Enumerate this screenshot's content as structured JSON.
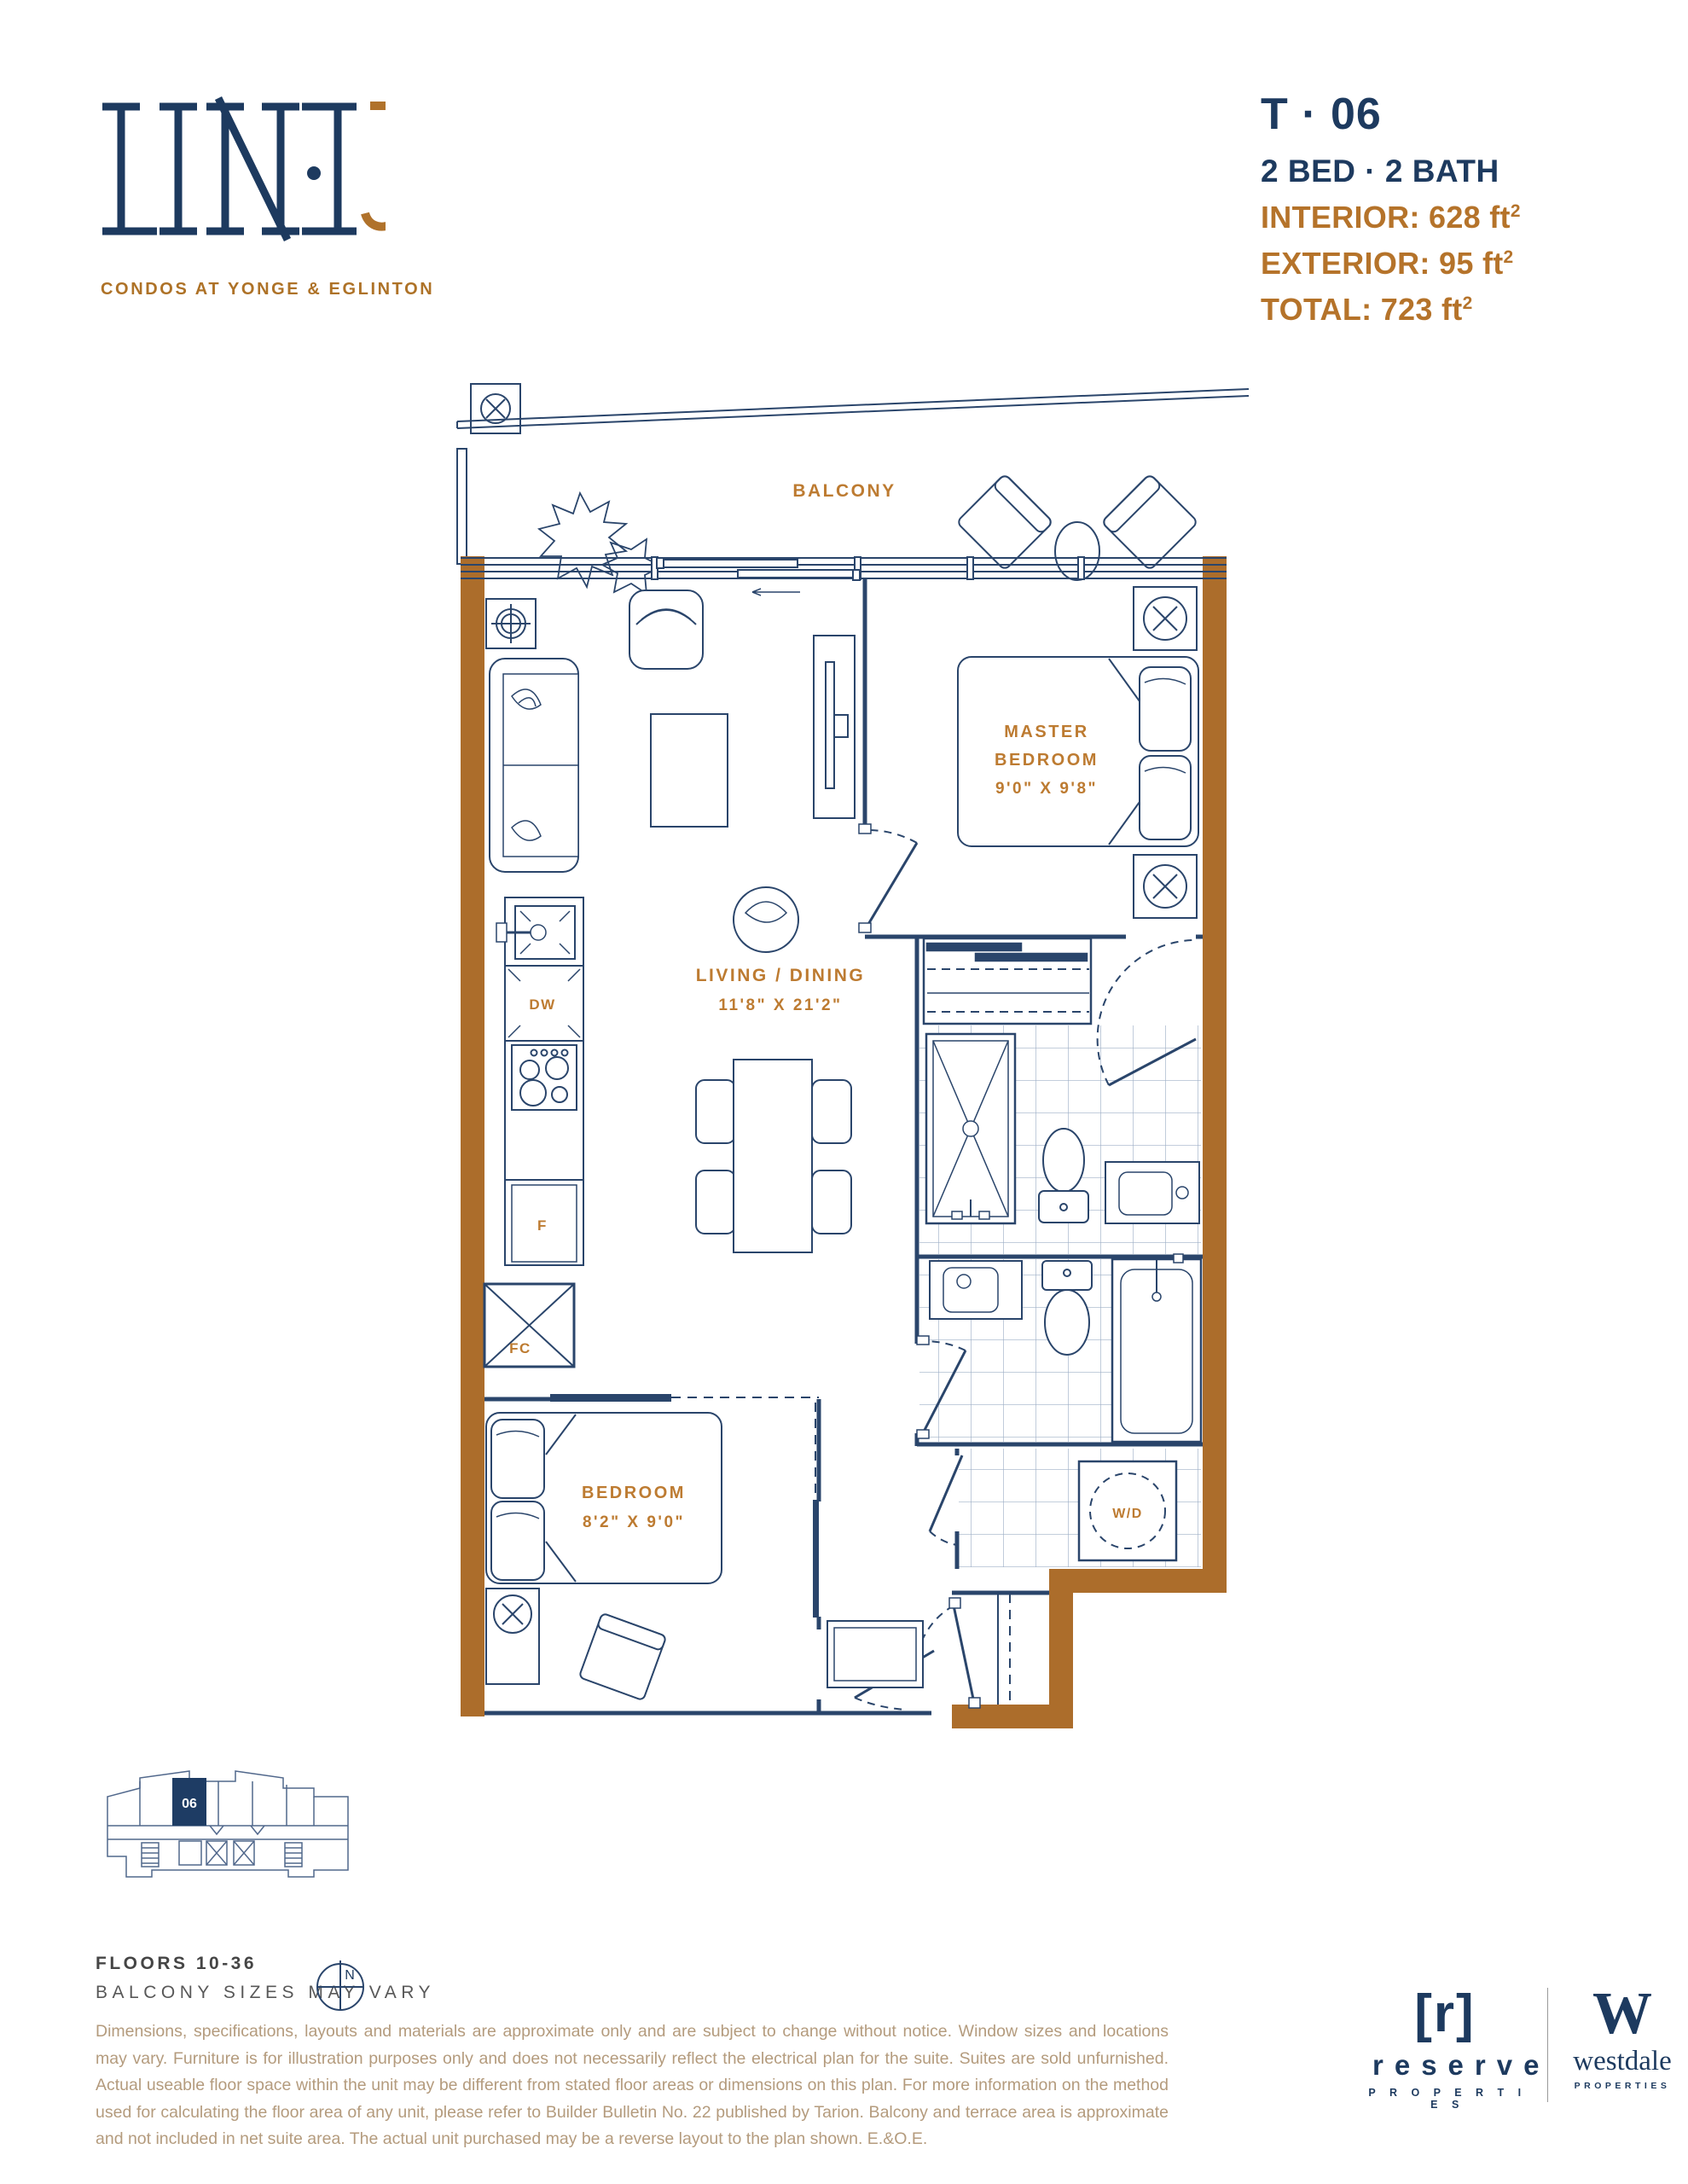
{
  "colors": {
    "navy": "#1d3a5f",
    "line_navy": "#2A456B",
    "wall_brown": "#AC6D2B",
    "label_bronze": "#BD7B31",
    "stat_bronze": "#B5732A",
    "disclaimer_tan": "#B49B7D"
  },
  "logo": {
    "wordmark": "LINE",
    "number": "5",
    "aria": "LINE 5",
    "tagline": "CONDOS AT YONGE & EGLINTON"
  },
  "unit": {
    "number": "T · 06",
    "config": "2 BED · 2 BATH",
    "sup": "2",
    "stats": [
      {
        "text": "INTERIOR: 628 ft"
      },
      {
        "text": "EXTERIOR: 95 ft"
      },
      {
        "text": "TOTAL: 723 ft"
      }
    ]
  },
  "plan": {
    "balcony_label": "BALCONY",
    "master": {
      "name1": "MASTER",
      "name2": "BEDROOM",
      "dims": "9'0\" X 9'8\""
    },
    "living": {
      "name": "LIVING / DINING",
      "dims": "11'8\" X 21'2\""
    },
    "bedroom": {
      "name": "BEDROOM",
      "dims": "8'2\" X 9'0\""
    },
    "appliances": {
      "dw": "DW",
      "f": "F",
      "fc": "FC",
      "wd": "W/D"
    }
  },
  "keyplan": {
    "unit": "06",
    "floors": "FLOORS 10-36",
    "note": "BALCONY SIZES MAY VARY",
    "north": "N"
  },
  "disclaimer": "Dimensions, specifications, layouts and materials are approximate only and are subject to change without notice. Window sizes and locations may vary. Furniture is for illustration purposes only and does not necessarily reflect the electrical plan for the suite. Suites are sold unfurnished. Actual useable floor space within the unit may be different from stated floor areas or dimensions on this plan. For more information on the method used for calculating the floor area of any unit, please refer to Builder Bulletin No. 22 published by Tarion. Balcony and terrace area is approximate and not included in net suite area. The actual unit purchased may be a reverse layout to the plan shown. E.&O.E.",
  "footer": {
    "reserve_mark": "[r]",
    "reserve_name": "reserve",
    "reserve_sub": "P R O P E R T I E S",
    "westdale_mark": "W",
    "westdale_name": "westdale",
    "westdale_sub": "PROPERTIES"
  }
}
